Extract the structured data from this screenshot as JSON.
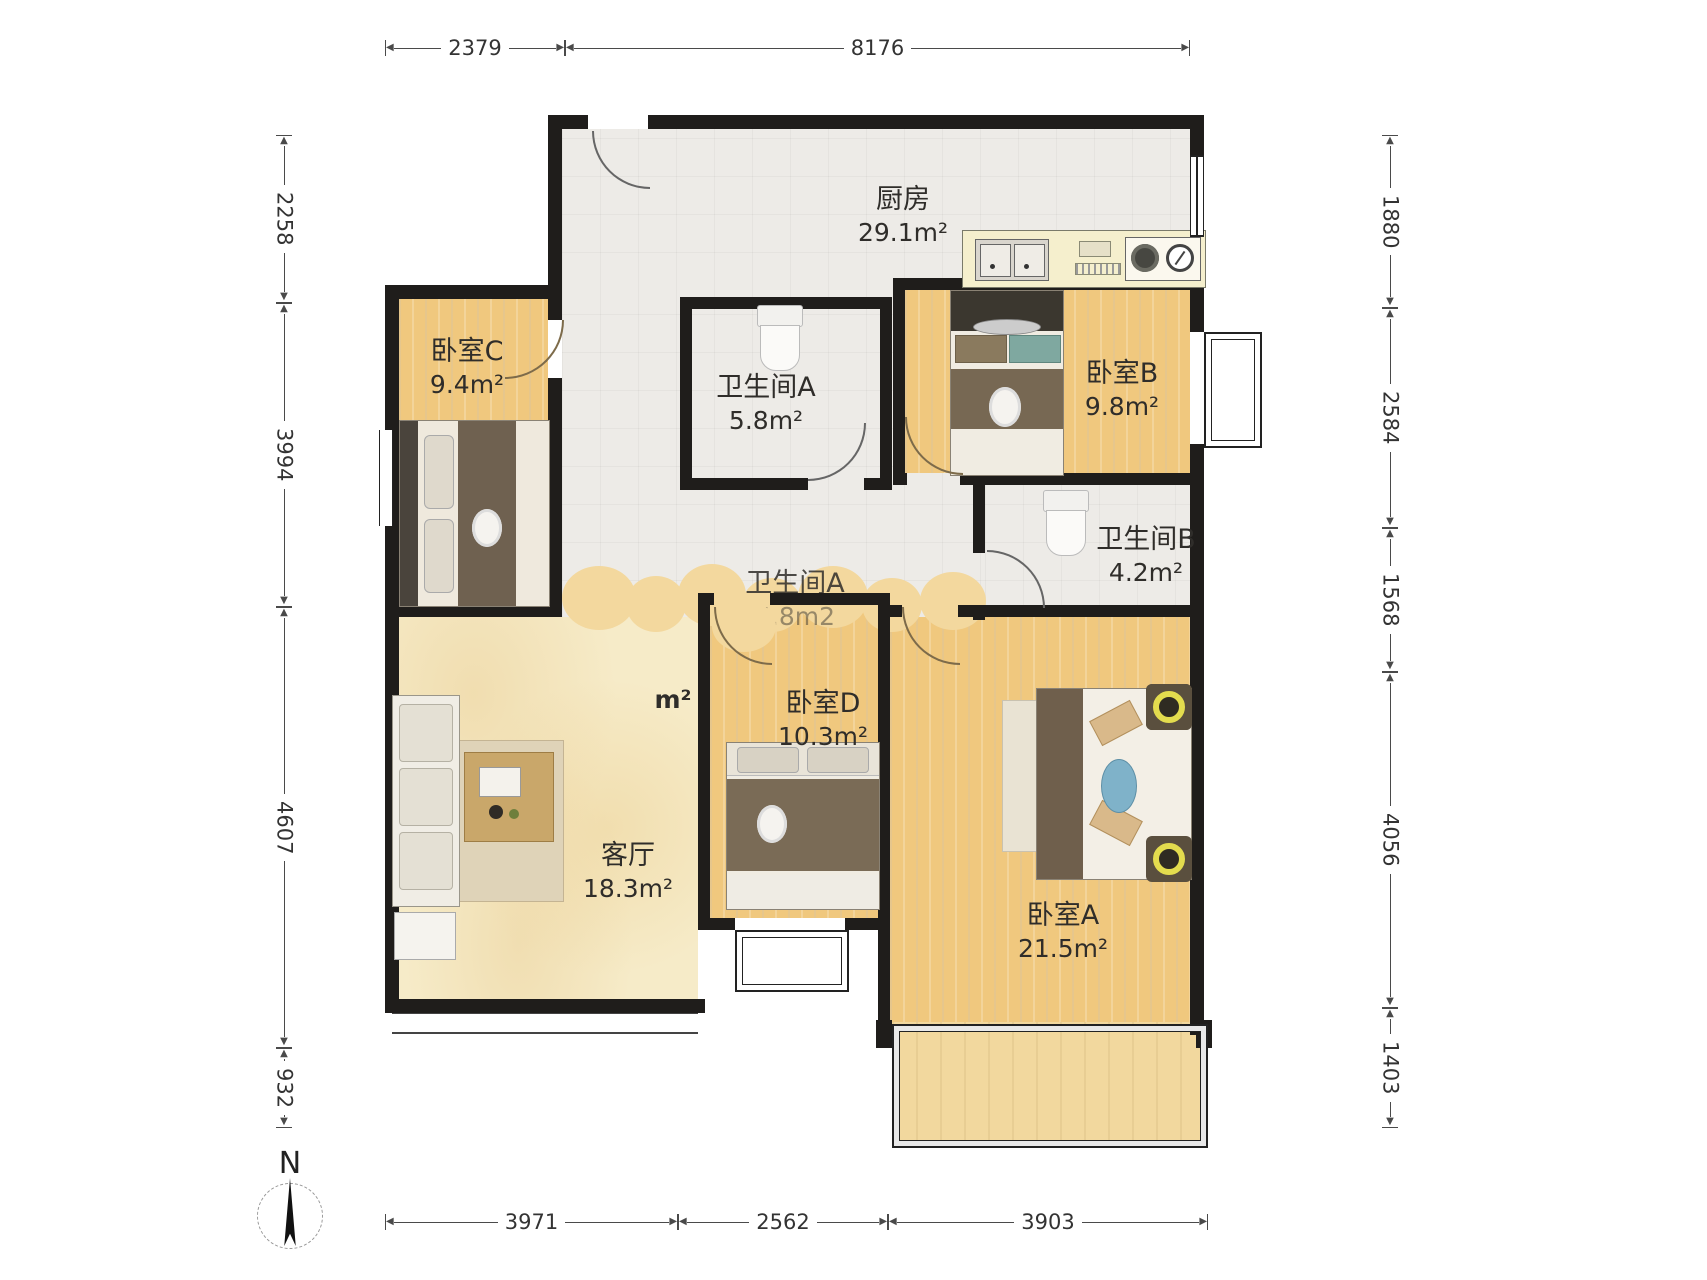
{
  "floorplan": {
    "compass_label": "N",
    "rooms": [
      {
        "name": "厨房",
        "area": "29.1m²"
      },
      {
        "name": "卧室C",
        "area": "9.4m²"
      },
      {
        "name": "卫生间A",
        "area": "5.8m²"
      },
      {
        "name": "卧室B",
        "area": "9.8m²"
      },
      {
        "name": "卫生间B",
        "area": "4.2m²"
      },
      {
        "name": "客厅",
        "area": "18.3m²"
      },
      {
        "name": "卧室D",
        "area": "10.3m²"
      },
      {
        "name": "卧室A",
        "area": "21.5m²"
      },
      {
        "name": "卫生间A",
        "area": "5.8m2"
      },
      {
        "name": "",
        "area": "m²"
      }
    ],
    "dimensions": {
      "top": [
        "2379",
        "8176"
      ],
      "left": [
        "2258",
        "3994",
        "4607",
        "932"
      ],
      "right": [
        "1880",
        "2584",
        "1568",
        "4056",
        "1403"
      ],
      "bottom": [
        "3971",
        "2562",
        "3903"
      ]
    },
    "colors": {
      "wall": "#1f1d1b",
      "wood_floor": "#f0c87e",
      "living_floor": "#f6ebc8",
      "tile_floor": "#edebe7",
      "balcony_floor": "#f2d89e"
    }
  }
}
